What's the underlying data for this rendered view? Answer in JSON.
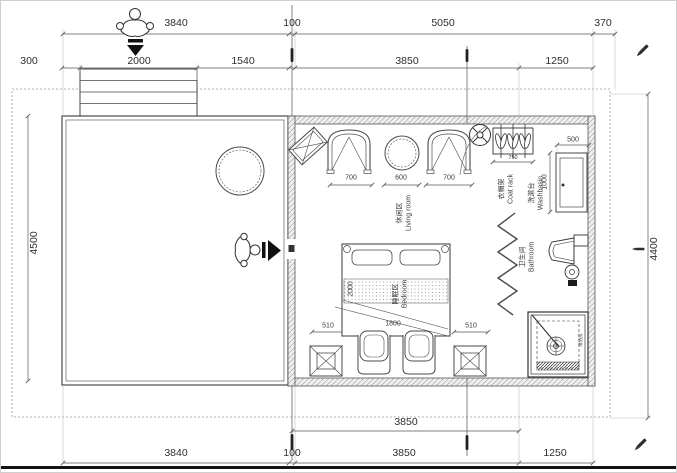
{
  "dims": {
    "top1": [
      "3840",
      "100",
      "5050",
      "370"
    ],
    "top2": [
      "300",
      "2000",
      "1540",
      "3850",
      "1250"
    ],
    "bottom_inner": "3850",
    "bottom": [
      "3840",
      "100",
      "3850",
      "1250"
    ],
    "left_total": "4500",
    "right_total": "4400",
    "living": [
      "700",
      "600",
      "700"
    ],
    "coat_rack": "750",
    "washbasin_w": "500",
    "washbasin_d": "1000",
    "bed_len": "2000",
    "bed_wid": "1800",
    "nightstand_left": "510",
    "nightstand_right": "510"
  },
  "labels": {
    "living": {
      "zh": "休闲区",
      "en": "Living room"
    },
    "coatrack": {
      "zh": "衣帽架",
      "en": "Coat rack"
    },
    "washbasin": {
      "zh": "洗漱台",
      "en": "Washbasin"
    },
    "bathroom": {
      "zh": "卫生间",
      "en": "Bathroom"
    },
    "bedroom": {
      "zh": "睡眠区",
      "en": "Bedroom"
    },
    "shower": {
      "zh": "淋浴房"
    }
  },
  "icons": {
    "person": "person-top-view-icon",
    "entry_arrow": "entry-arrow-icon",
    "pencil": "pencil-marker-icon",
    "fan": "ceiling-fan-icon",
    "drain": "floor-drain-icon",
    "hanger": "coat-hanger-icon"
  },
  "colors": {
    "line": "#4a4a4a",
    "dim_line": "#5a5a5a",
    "text": "#2f2f2f",
    "boundary": "#999999",
    "marker": "#141414"
  }
}
